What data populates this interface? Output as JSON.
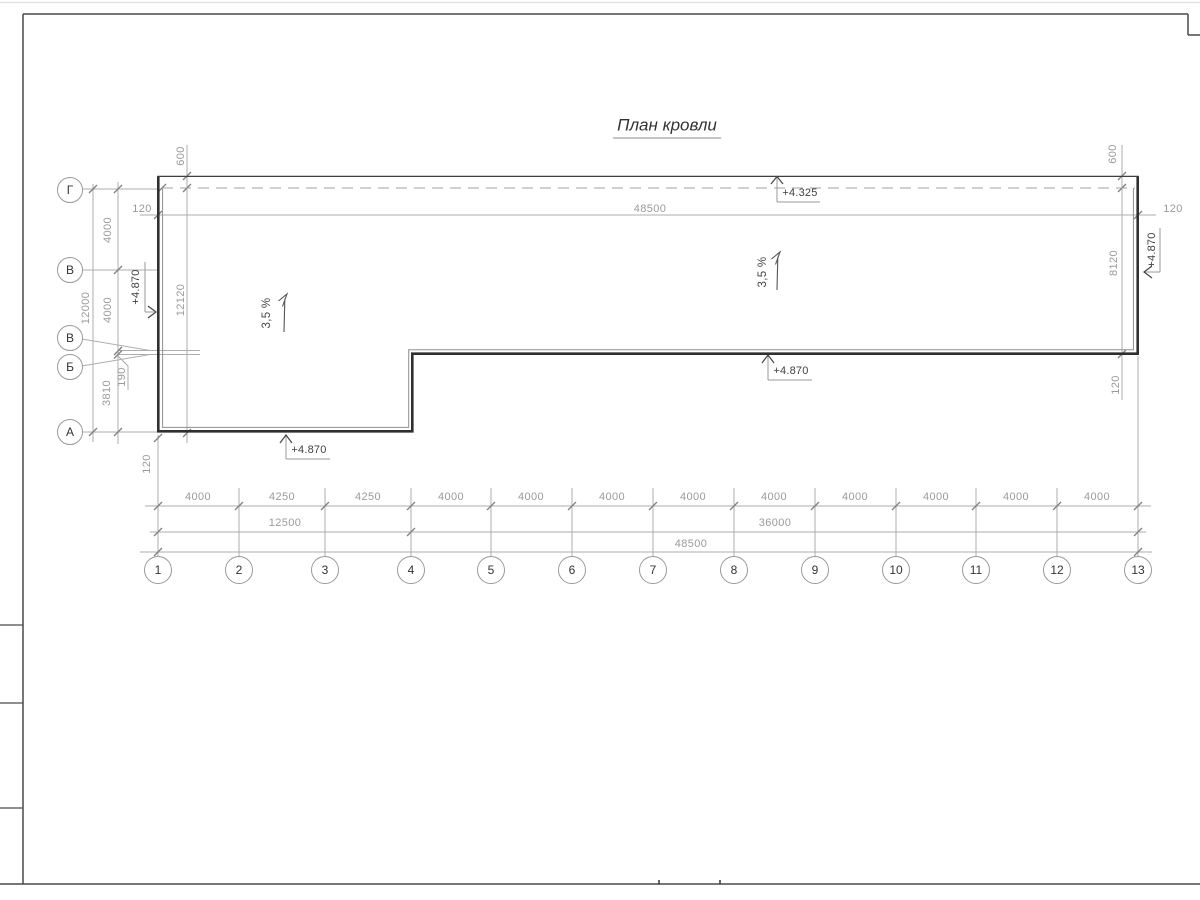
{
  "title": "План кровли",
  "axis_circles": {
    "bottom": [
      "1",
      "2",
      "3",
      "4",
      "5",
      "6",
      "7",
      "8",
      "9",
      "10",
      "11",
      "12",
      "13"
    ],
    "left": [
      "Г",
      "В",
      "В",
      "Б",
      "А"
    ]
  },
  "dims": {
    "top_total": "48500",
    "top_offset_left": "120",
    "top_offset_right": "120",
    "parapet_left": "600",
    "parapet_right": "600",
    "left_height": "12120",
    "right_height": "8120",
    "left_chain": [
      "4000",
      "4000",
      "190",
      "3810"
    ],
    "left_total": "12000",
    "corner_left": "120",
    "corner_right": "120",
    "bottom_chain": [
      "4000",
      "4250",
      "4250",
      "4000",
      "4000",
      "4000",
      "4000",
      "4000",
      "4000",
      "4000",
      "4000",
      "4000"
    ],
    "bottom_span_1_4": "12500",
    "bottom_span_4_13": "36000",
    "bottom_total": "48500"
  },
  "marks": {
    "ridge": "+4.325",
    "eave_left": "+4.870",
    "eave_right": "+4.870",
    "eave_bottom": "+4.870",
    "eave_mid": "+4.870",
    "slope_left": "3,5 %",
    "slope_right": "3,5 %"
  },
  "colors": {
    "roof_line": "#2f2f2f",
    "dim_line": "#aeaeae",
    "dim_text": "#9a9a9a",
    "frame": "#4a4a4a"
  }
}
